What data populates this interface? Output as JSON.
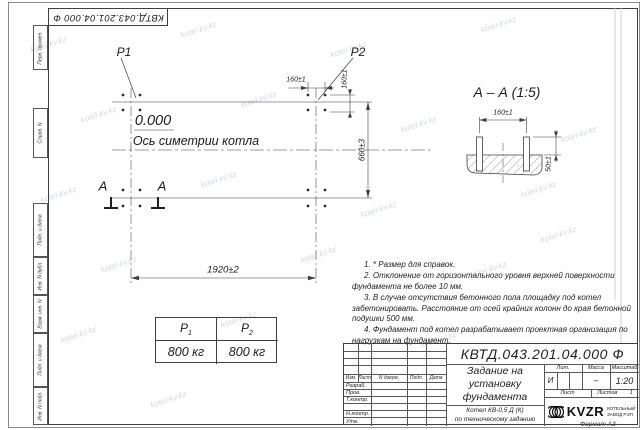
{
  "colors": {
    "ink": "#3f3f3f",
    "paper": "#ffffff",
    "watermark": "#9fb0bf"
  },
  "watermark": {
    "text": "kotel-kv.kz"
  },
  "corner_stamp": {
    "designation": "КВТД.043.201.04.000 Ф"
  },
  "sidebar": {
    "items": [
      "Перв. примен.",
      "Справ. N",
      "Подп. и дата",
      "Инв. N дубл.",
      "Взам. инв. N",
      "Подп. и дата",
      "Инв. N подл."
    ]
  },
  "plan": {
    "p1_label": "P1",
    "p2_label": "P2",
    "elevation": "0.000",
    "axis_label": "Ось симетрии котла",
    "section_letter": "А",
    "dim_width": "1920±2",
    "dim_bolt_h": "160±1",
    "dim_bolt_v": "160±1",
    "dim_height": "660±3"
  },
  "section": {
    "title": "А – А (1:5)",
    "dim_bolt": "160±1",
    "dim_protrusion": "50±1"
  },
  "load_table": {
    "headers": [
      {
        "base": "P",
        "sub": "1"
      },
      {
        "base": "P",
        "sub": "2"
      }
    ],
    "values": [
      "800 кг",
      "800 кг"
    ]
  },
  "notes": [
    "1. * Размер для справок.",
    "2. Отклонение от горизонтального уровня верхней поверхности фундамента не более 10 мм.",
    "3. В случае отсутствия бетонного пола площадку под котел забетонировать. Расстояние от осей крайних колонн до края бетонной подушки 500 мм.",
    "4. Фундамент под котел разрабатывает проектная организация по нагрузкам на фундамент."
  ],
  "title_block": {
    "designation": "КВТД.043.201.04.000 Ф",
    "doc_title_lines": [
      "Задание на",
      "установку",
      "фундамента"
    ],
    "product_lines": [
      "Котел КВ-0,5 Д (К)",
      "по техническому заданию"
    ],
    "header_cols": [
      "Изм.",
      "Лист",
      "N докум.",
      "Подп.",
      "Дата"
    ],
    "sig_rows": [
      "Разраб.",
      "Пров.",
      "Т.контр.",
      "Н.контр.",
      "Утв."
    ],
    "lit_label": "Лит.",
    "lit_value": "И",
    "mass_label": "Масса",
    "mass_value": "–",
    "scale_label": "Масштаб",
    "scale_value": "1:20",
    "sheet_label": "Лист",
    "sheets_label": "Листов",
    "sheets_value": "1",
    "company": {
      "logo_text": "KVZR",
      "name_line1": "КОТЕЛЬНЫЙ",
      "name_line2": "ЗАВОД РЭП"
    },
    "format_label": "Формат А3"
  }
}
